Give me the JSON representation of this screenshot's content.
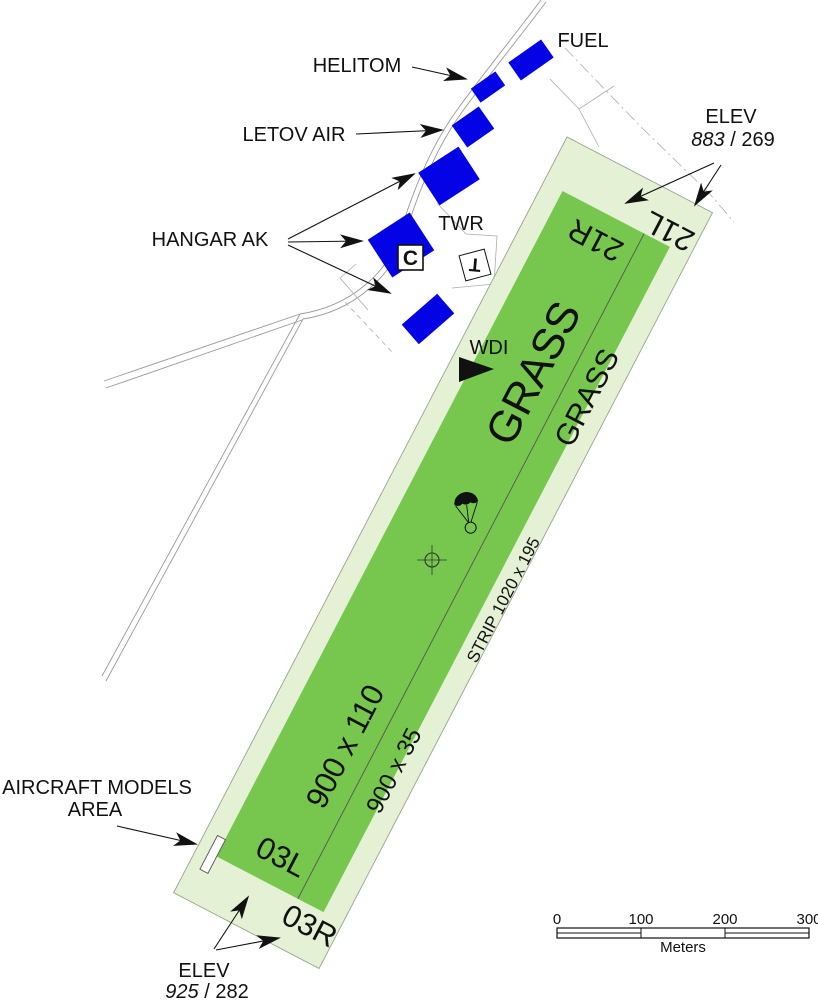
{
  "map": {
    "buildings": {
      "fuel": "FUEL",
      "helitom": "HELITOM",
      "letov": "LETOV AIR",
      "hangar": "HANGAR AK",
      "tower": "TWR",
      "tower_symbol": "T",
      "hangar_code": "C"
    },
    "wdi_label": "WDI",
    "elev_ne": {
      "label": "ELEV",
      "feet": "883",
      "sep": " / ",
      "meters": "269"
    },
    "elev_sw": {
      "label": "ELEV",
      "feet": "925",
      "sep": " / ",
      "meters": "282"
    },
    "runway": {
      "num_21r": "21R",
      "num_21l": "21L",
      "num_03l": "03L",
      "num_03r": "03R",
      "grass_main": "GRASS",
      "grass_sec": "GRASS",
      "dim_main": "900 x 110",
      "dim_sec": "900 x 35",
      "strip": "STRIP 1020 x 195"
    },
    "models_area": {
      "line1": "AIRCRAFT MODELS",
      "line2": "AREA"
    },
    "scale": {
      "ticks": [
        "0",
        "100",
        "200",
        "300"
      ],
      "unit": "Meters"
    },
    "icons": {
      "wdi": "wind-direction-indicator",
      "parachute": "parachute-jump-area",
      "crosshair": "aerodrome-reference-point"
    },
    "colors": {
      "runway_green": "#77c74e",
      "strip_green": "#e4f1d5",
      "building_blue": "#0303e6",
      "ink": "#111111"
    }
  }
}
